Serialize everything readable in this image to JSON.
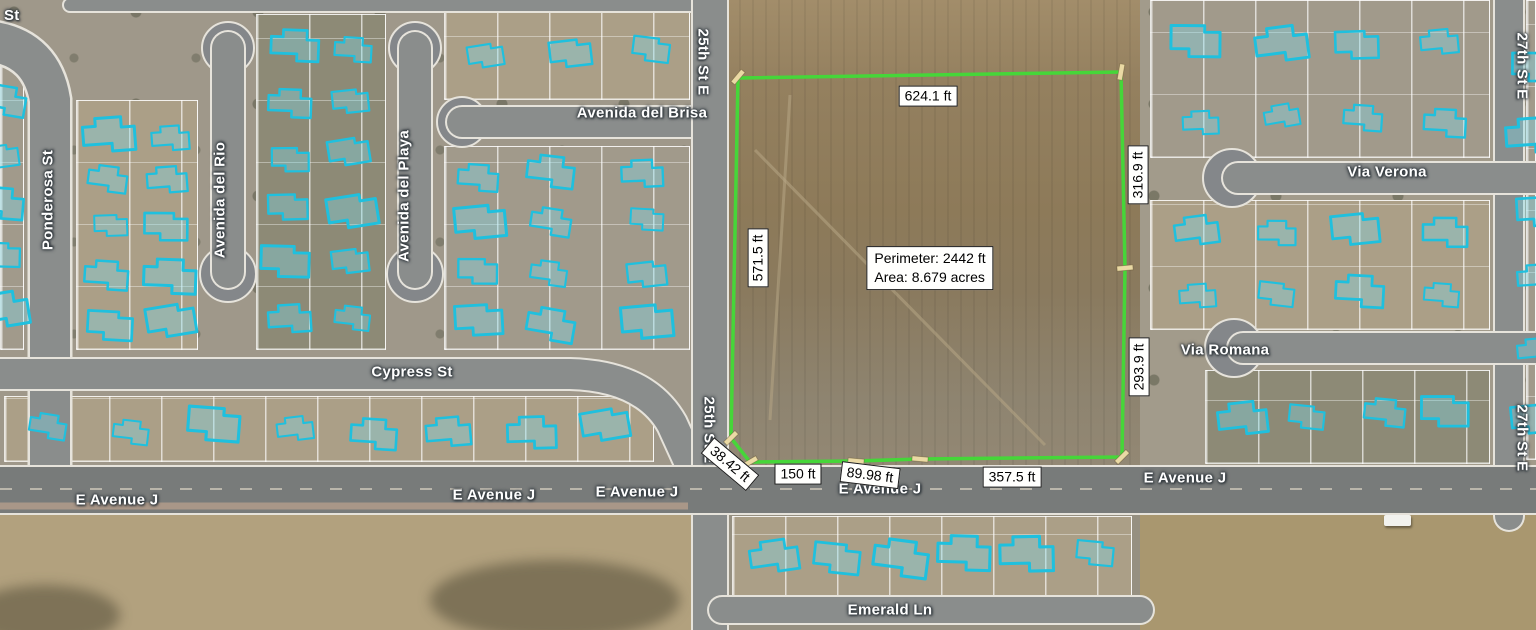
{
  "map": {
    "street_labels": {
      "partial_st": "St",
      "ponderosa": "Ponderosa St",
      "avenida_del_rio": "Avenida del Rio",
      "avenida_del_playa": "Avenida del Playa",
      "avenida_del_brisa": "Avenida del Brisa",
      "cypress": "Cypress St",
      "st_25": "25th St E",
      "st_27": "27th St E",
      "e_avenue_j": "E Avenue J",
      "via_verona": "Via Verona",
      "via_romana": "Via Romana",
      "emerald_ln": "Emerald Ln"
    },
    "measurements": {
      "top_edge": "624.1 ft",
      "left_edge": "571.5 ft",
      "right_upper": "316.9 ft",
      "right_lower": "293.9 ft",
      "corner_chamfer": "38.42 ft",
      "bottom_1": "150 ft",
      "bottom_2": "89.98 ft",
      "bottom_3": "357.5 ft",
      "summary_perimeter": "Perimeter: 2442 ft",
      "summary_area": "Area: 8.679 acres",
      "perimeter_ft": 2442,
      "area_acres": 8.679
    },
    "colors": {
      "parcel_outline": "#46d639",
      "house_highlight": "#1fc0de",
      "vertex_tick": "#ead9a4",
      "label_bg": "#ffffff",
      "label_border": "#000000"
    }
  }
}
